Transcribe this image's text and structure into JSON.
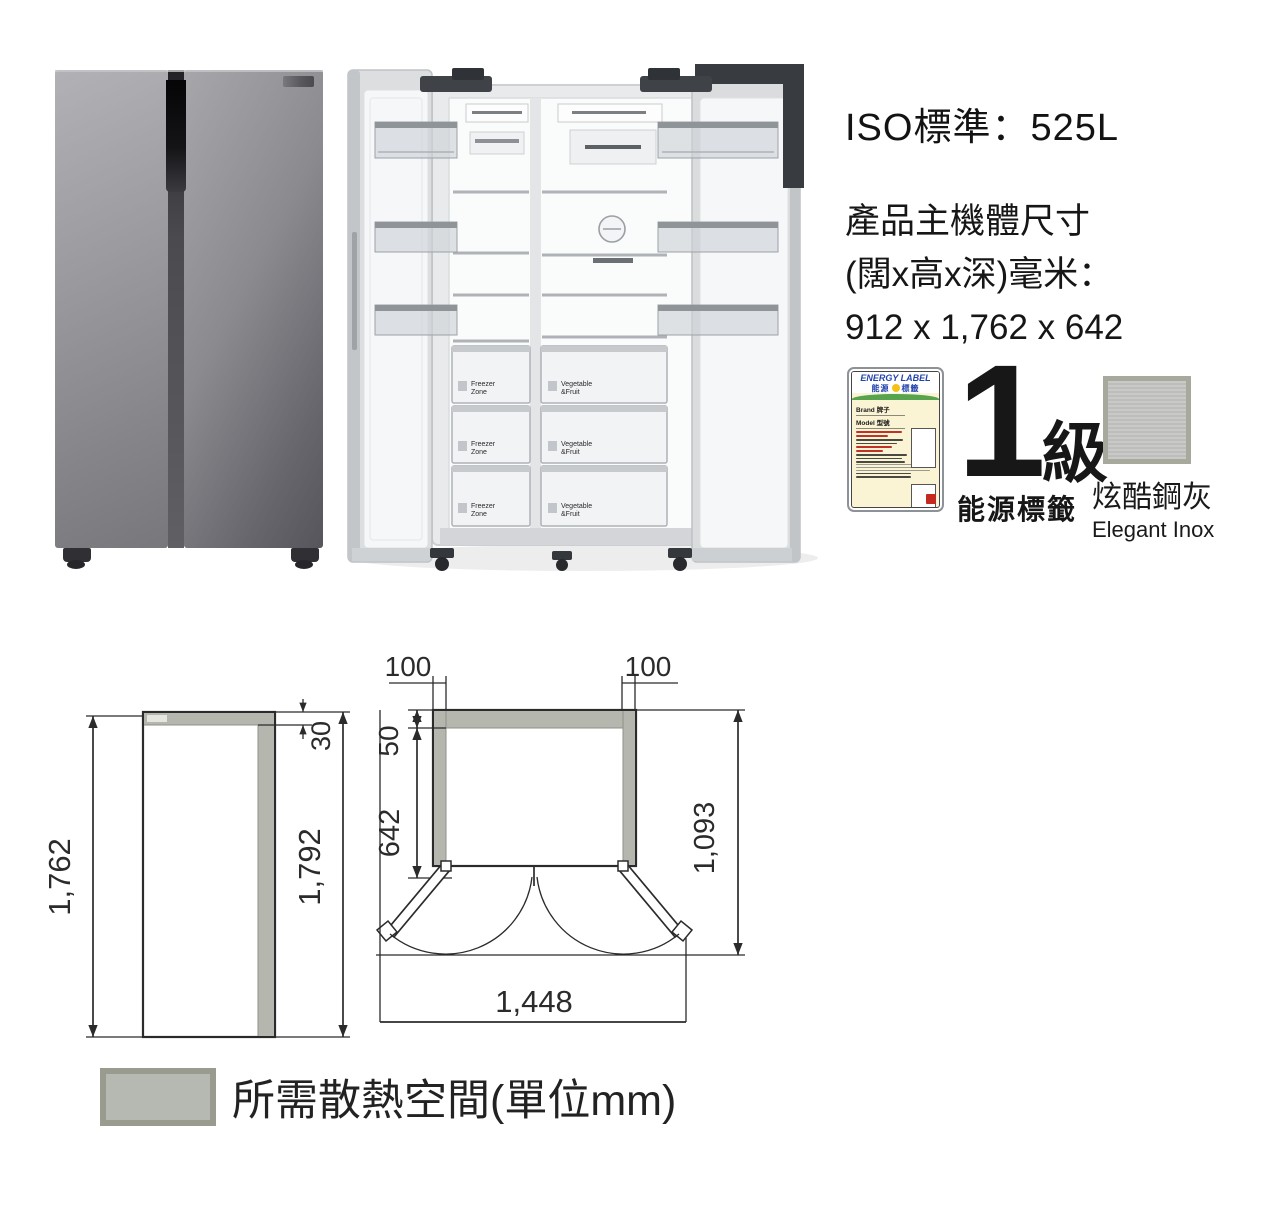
{
  "specs": {
    "iso_line": "ISO標準：525L",
    "dims_title": "產品主機體尺寸",
    "dims_unit": "(闊x高x深)毫米：",
    "dims_value": "912 x 1,762 x 642"
  },
  "energy_label": {
    "title": "ENERGY LABEL",
    "subtitle_left": "能源",
    "subtitle_right": "標籤",
    "brand_row": "Brand 牌子",
    "model_row": "Model 型號"
  },
  "grade": {
    "number": "1",
    "suffix": "級",
    "caption": "能源標籤"
  },
  "finish": {
    "name_zh": "炫酷鋼灰",
    "name_en": "Elegant Inox"
  },
  "open_view": {
    "freezer_line1": "Freezer",
    "freezer_line2": "Zone",
    "vegetable_line1": "Vegetable",
    "vegetable_line2": "&Fruit"
  },
  "diagrams": {
    "side_view": {
      "body_height": "1,762",
      "top_clearance": "30",
      "total_height": "1,792"
    },
    "top_view": {
      "left_clearance": "100",
      "right_clearance": "100",
      "rear_clearance": "50",
      "body_depth": "642",
      "total_depth": "1,093",
      "total_width": "1,448"
    },
    "legend_text": "所需散熱空間(單位mm)"
  },
  "colors": {
    "clearance_fill": "#b5b7af",
    "line": "#2b2b2b",
    "energy_blue": "#2344ad",
    "energy_red": "#c03228",
    "seal_red": "#c4281e"
  }
}
